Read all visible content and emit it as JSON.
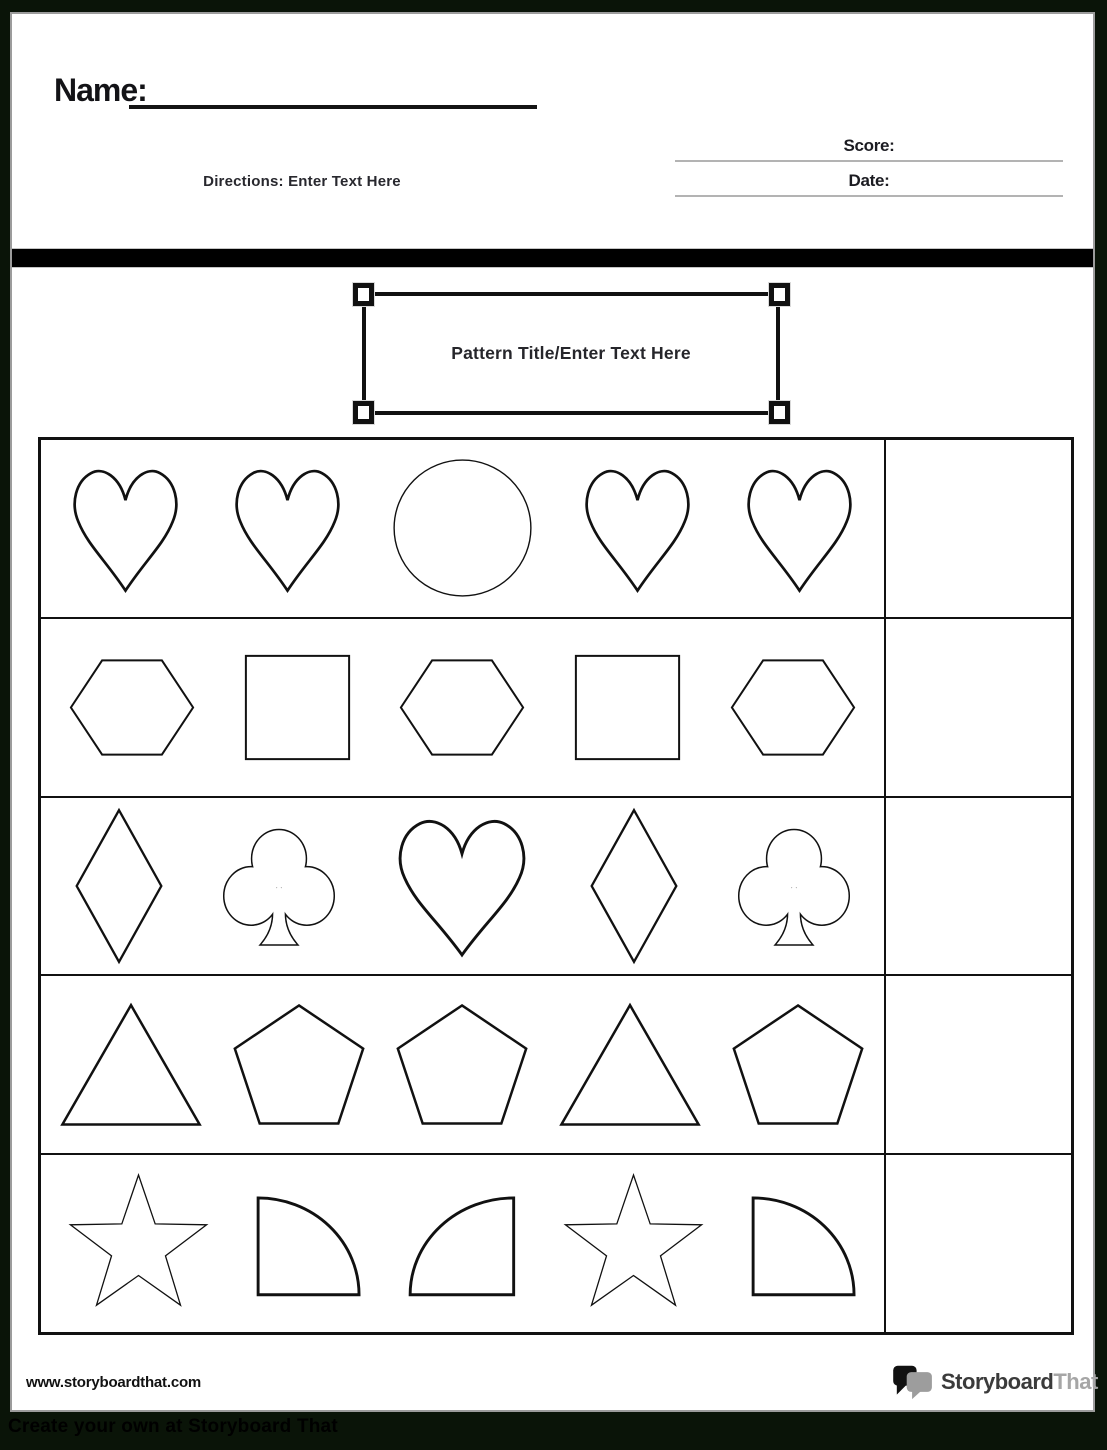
{
  "header": {
    "name_label": "Name:",
    "directions": "Directions: Enter Text Here",
    "score_label": "Score:",
    "date_label": "Date:"
  },
  "title_box": {
    "title": "Pattern Title/Enter Text Here"
  },
  "worksheet": {
    "rows": [
      {
        "shapes": [
          "heart",
          "heart",
          "circle",
          "heart",
          "heart"
        ],
        "answer": ""
      },
      {
        "shapes": [
          "hexagon",
          "square",
          "hexagon",
          "square",
          "hexagon"
        ],
        "answer": ""
      },
      {
        "shapes": [
          "diamond",
          "club",
          "heart",
          "diamond",
          "club"
        ],
        "answer": ""
      },
      {
        "shapes": [
          "triangle",
          "pentagon",
          "pentagon",
          "triangle",
          "pentagon"
        ],
        "answer": ""
      },
      {
        "shapes": [
          "star",
          "quarter-circle",
          "quarter-circle-mirrored",
          "star",
          "quarter-circle"
        ],
        "answer": ""
      }
    ]
  },
  "footer": {
    "website": "www.storyboardthat.com",
    "logo_text_primary": "Storyboard",
    "logo_text_secondary": "That",
    "bottom_bar_text": "Create your own at Storyboard That"
  },
  "colors": {
    "page_background": "#ffffff",
    "frame_background": "#0a1408",
    "divider_bar": "#000000",
    "line_gray": "#b3b3b3",
    "ink": "#111111"
  }
}
